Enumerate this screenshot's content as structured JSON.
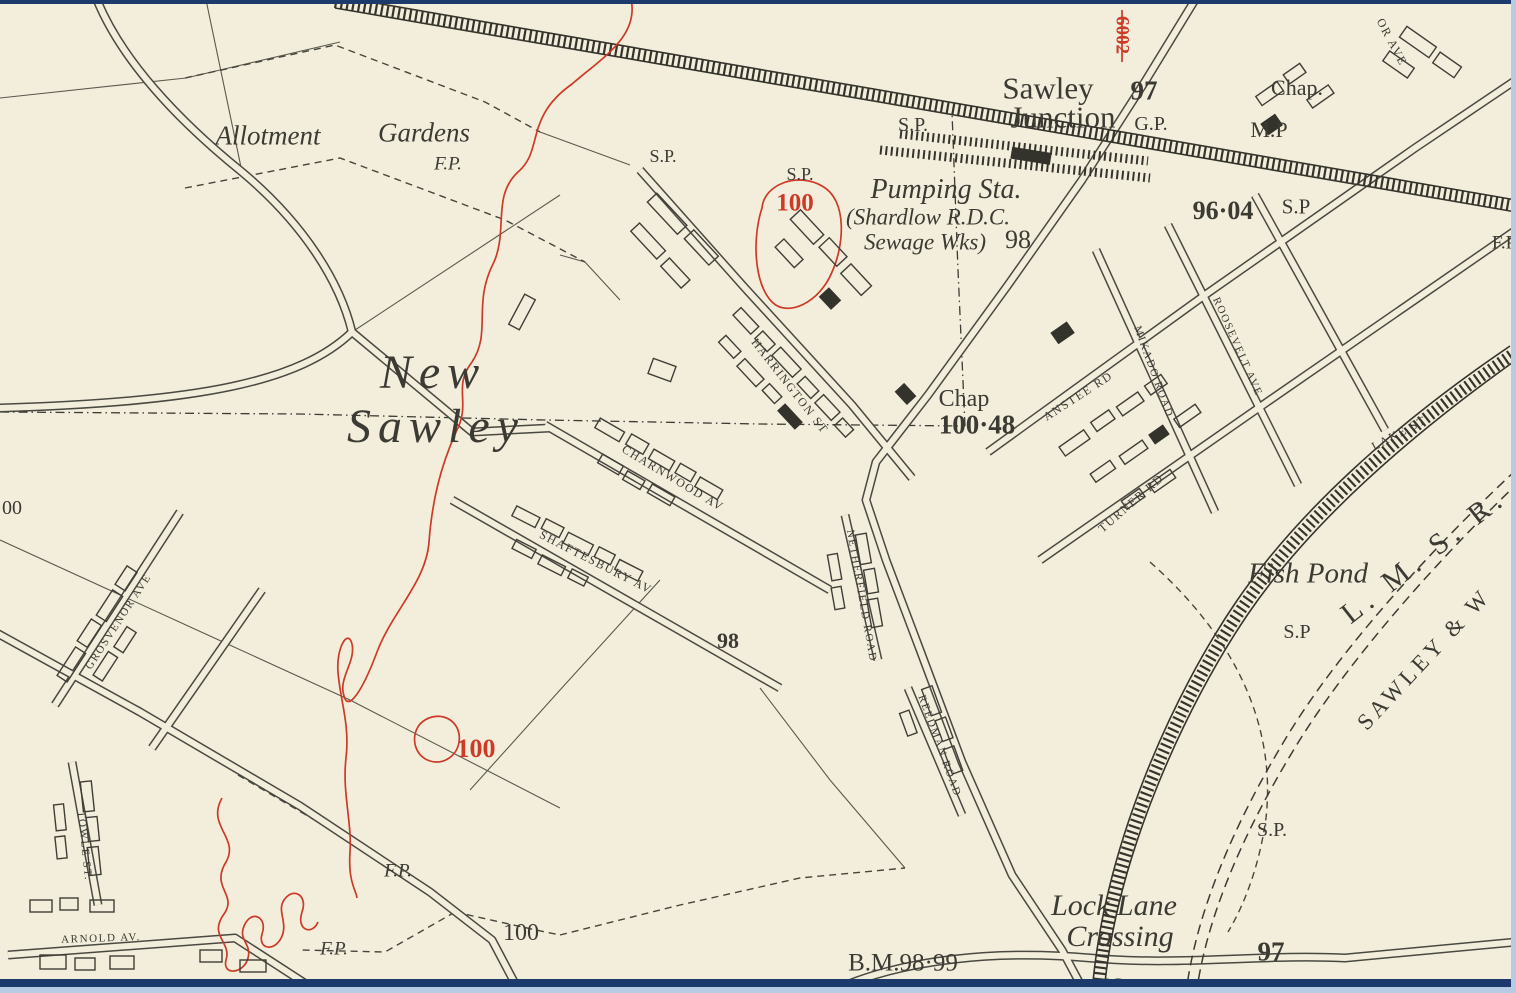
{
  "map": {
    "description": "Historical Ordnance Survey style town map of New Sawley and Sawley Junction",
    "colors": {
      "paper": "#f3eedc",
      "ink": "#3b3a33",
      "contour_red": "#cc3a28",
      "frame_navy": "#1c3a6c",
      "frame_lightblue": "#b7cbe5"
    },
    "labels": [
      {
        "id": "allotment-label",
        "text": "Allotment",
        "x": 268,
        "y": 136,
        "size": 27,
        "cls": "italic"
      },
      {
        "id": "gardens-label",
        "text": "Gardens",
        "x": 424,
        "y": 133,
        "size": 27,
        "cls": "italic"
      },
      {
        "id": "fp-allotment",
        "text": "F.P.",
        "x": 448,
        "y": 164,
        "size": 19,
        "cls": "italic"
      },
      {
        "id": "sp-rail-left",
        "text": "S.P.",
        "x": 663,
        "y": 156,
        "size": 18,
        "cls": ""
      },
      {
        "id": "sp-junction-west",
        "text": "S.P.",
        "x": 913,
        "y": 125,
        "size": 20,
        "cls": ""
      },
      {
        "id": "sp-pumping-north",
        "text": "S.P.",
        "x": 800,
        "y": 174,
        "size": 18,
        "cls": ""
      },
      {
        "id": "sawley-junction-line1",
        "text": "Sawley",
        "x": 1048,
        "y": 88,
        "size": 31,
        "cls": ""
      },
      {
        "id": "sawley-junction-line2",
        "text": "Junction",
        "x": 1063,
        "y": 117,
        "size": 31,
        "cls": ""
      },
      {
        "id": "spot-height-97-junction",
        "text": "97",
        "x": 1144,
        "y": 91,
        "size": 27,
        "cls": "bold"
      },
      {
        "id": "gp-junction",
        "text": "G.P.",
        "x": 1151,
        "y": 124,
        "size": 20,
        "cls": ""
      },
      {
        "id": "chap-north",
        "text": "Chap.",
        "x": 1297,
        "y": 88,
        "size": 22,
        "cls": ""
      },
      {
        "id": "mp-north",
        "text": "M.P",
        "x": 1269,
        "y": 130,
        "size": 22,
        "cls": ""
      },
      {
        "id": "red-number-6002",
        "text": "6002",
        "x": 1122,
        "y": 35,
        "rot": 90,
        "size": 19,
        "cls": "red bold"
      },
      {
        "id": "avenue-partial",
        "text": "OR AVE",
        "x": 1392,
        "y": 42,
        "rot": 62,
        "size": 12,
        "cls": "caps"
      },
      {
        "id": "pumping-sta",
        "text": "Pumping Sta.",
        "x": 946,
        "y": 190,
        "size": 28,
        "cls": "italic"
      },
      {
        "id": "shardlow-rdc",
        "text": "(Shardlow R.D.C.",
        "x": 928,
        "y": 217,
        "size": 23,
        "cls": "italic"
      },
      {
        "id": "sewage-wks",
        "text": "Sewage Wks)",
        "x": 925,
        "y": 242,
        "size": 23,
        "cls": "italic"
      },
      {
        "id": "spot-height-98-pumping",
        "text": "98",
        "x": 1018,
        "y": 240,
        "size": 26,
        "cls": ""
      },
      {
        "id": "contour-100-ring",
        "text": "100",
        "x": 795,
        "y": 203,
        "size": 25,
        "cls": "red bold"
      },
      {
        "id": "spot-height-9604",
        "text": "96·04",
        "x": 1223,
        "y": 211,
        "size": 26,
        "cls": "bold"
      },
      {
        "id": "sp-9604",
        "text": "S.P",
        "x": 1296,
        "y": 207,
        "size": 21,
        "cls": ""
      },
      {
        "id": "fp-right-edge",
        "text": "F.P",
        "x": 1504,
        "y": 243,
        "size": 19,
        "cls": ""
      },
      {
        "id": "new-sawley-line1",
        "text": "New",
        "x": 433,
        "y": 373,
        "size": 48,
        "cls": "italic place"
      },
      {
        "id": "new-sawley-line2",
        "text": "Sawley",
        "x": 436,
        "y": 427,
        "size": 48,
        "cls": "italic place"
      },
      {
        "id": "harrington-st",
        "text": "HARRINGTON ST",
        "x": 790,
        "y": 386,
        "rot": 52,
        "size": 12,
        "cls": "caps"
      },
      {
        "id": "charnwood-av",
        "text": "CHARNWOOD AV",
        "x": 673,
        "y": 478,
        "rot": 31,
        "size": 12,
        "cls": "caps"
      },
      {
        "id": "shaftesbury-av",
        "text": "SHAFTESBURY AV",
        "x": 596,
        "y": 562,
        "rot": 27,
        "size": 12,
        "cls": "caps"
      },
      {
        "id": "chap-south",
        "text": "Chap",
        "x": 964,
        "y": 399,
        "size": 24,
        "cls": ""
      },
      {
        "id": "spot-height-10048",
        "text": "100·48",
        "x": 977,
        "y": 425,
        "size": 27,
        "cls": "bold"
      },
      {
        "id": "anstee-rd",
        "text": "ANSTEE RD",
        "x": 1078,
        "y": 396,
        "rot": -33,
        "size": 12,
        "cls": "caps"
      },
      {
        "id": "turner-rd",
        "text": "TURNER RD",
        "x": 1131,
        "y": 503,
        "rot": -41,
        "size": 12,
        "cls": "caps"
      },
      {
        "id": "roosevelt-ave",
        "text": "ROOSEVELT AVE",
        "x": 1237,
        "y": 347,
        "rot": 66,
        "size": 11,
        "cls": "caps"
      },
      {
        "id": "mikado-road",
        "text": "MIKADO ROAD",
        "x": 1153,
        "y": 372,
        "rot": 70,
        "size": 11,
        "cls": "caps"
      },
      {
        "id": "lake-st",
        "text": "LAKE ST",
        "x": 1399,
        "y": 433,
        "rot": -28,
        "size": 12,
        "cls": "caps"
      },
      {
        "id": "fish-pond",
        "text": "Fish Pond",
        "x": 1308,
        "y": 574,
        "size": 29,
        "cls": "italic"
      },
      {
        "id": "sp-fishpond",
        "text": "S.P",
        "x": 1297,
        "y": 632,
        "size": 20,
        "cls": ""
      },
      {
        "id": "lmsr-railway",
        "text": "L. M. S. R.",
        "x": 1424,
        "y": 556,
        "rot": -38,
        "size": 30,
        "cls": "sp"
      },
      {
        "id": "sawley-and-w-railway",
        "text": "SAWLEY & W",
        "x": 1424,
        "y": 659,
        "rot": -47,
        "size": 23,
        "cls": "caps sp2"
      },
      {
        "id": "sp-curve",
        "text": "S.P.",
        "x": 1272,
        "y": 830,
        "size": 20,
        "cls": ""
      },
      {
        "id": "netherfield-road",
        "text": "NETHERFIELD ROAD",
        "x": 861,
        "y": 596,
        "rot": 80,
        "size": 11,
        "cls": "caps"
      },
      {
        "id": "reedman-road",
        "text": "REEDMAN ROAD",
        "x": 939,
        "y": 746,
        "rot": 70,
        "size": 11,
        "cls": "caps"
      },
      {
        "id": "spot-height-98-south",
        "text": "98",
        "x": 728,
        "y": 641,
        "size": 22,
        "cls": "bold"
      },
      {
        "id": "contour-100-west",
        "text": "100",
        "x": 476,
        "y": 749,
        "size": 26,
        "cls": "red bold"
      },
      {
        "id": "spot-height-100-path",
        "text": "100",
        "x": 521,
        "y": 933,
        "size": 24,
        "cls": ""
      },
      {
        "id": "fp-mid",
        "text": "F.P.",
        "x": 398,
        "y": 871,
        "size": 19,
        "cls": "italic"
      },
      {
        "id": "fp-bottom",
        "text": "F.P.",
        "x": 334,
        "y": 949,
        "size": 19,
        "cls": "italic"
      },
      {
        "id": "arnold-av",
        "text": "ARNOLD AV.",
        "x": 101,
        "y": 939,
        "rot": -2,
        "size": 11,
        "cls": "caps"
      },
      {
        "id": "towle-st",
        "text": "TOWLE ST.",
        "x": 84,
        "y": 846,
        "rot": 84,
        "size": 11,
        "cls": "caps"
      },
      {
        "id": "grosvenor-ave",
        "text": "GROSVENOR AVE",
        "x": 119,
        "y": 622,
        "rot": -57,
        "size": 11,
        "cls": "caps"
      },
      {
        "id": "lock-lane-line1",
        "text": "Lock Lane",
        "x": 1114,
        "y": 906,
        "size": 30,
        "cls": "italic"
      },
      {
        "id": "lock-lane-line2",
        "text": "Crossing",
        "x": 1120,
        "y": 937,
        "size": 30,
        "cls": "italic"
      },
      {
        "id": "benchmark-9899",
        "text": "B.M.98·99",
        "x": 903,
        "y": 963,
        "size": 25,
        "cls": ""
      },
      {
        "id": "spot-height-97-south",
        "text": "97",
        "x": 1271,
        "y": 952,
        "size": 27,
        "cls": "bold"
      },
      {
        "id": "sp-bottom",
        "text": "S.P",
        "x": 1113,
        "y": 985,
        "size": 16,
        "cls": ""
      },
      {
        "id": "spot-height-partial-left",
        "text": "00",
        "x": 12,
        "y": 508,
        "size": 20,
        "cls": ""
      }
    ]
  }
}
